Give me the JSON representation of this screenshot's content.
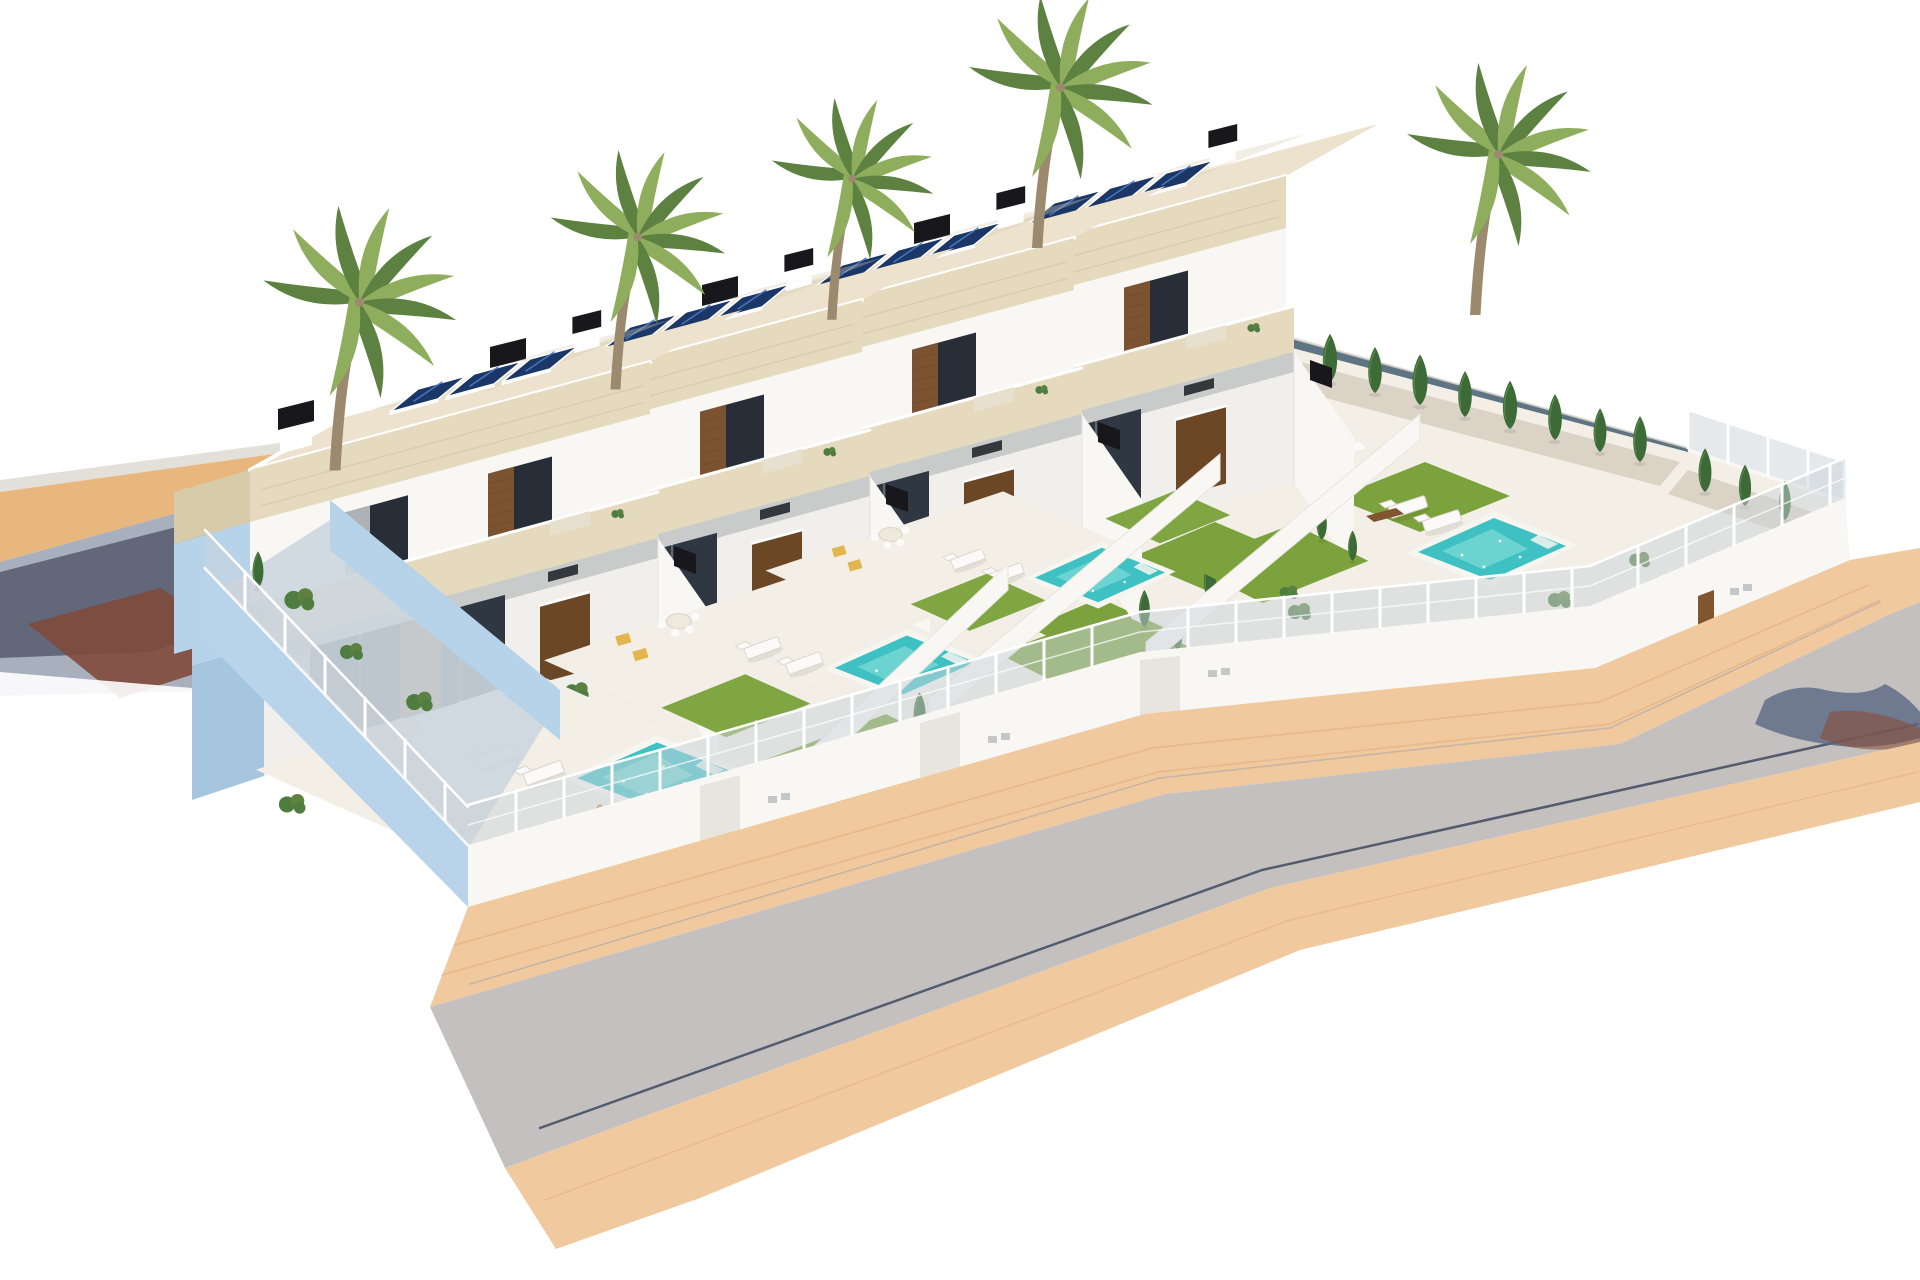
{
  "meta": {
    "title": "Aerial 3D architectural render",
    "description": "Computer-generated aerial rendering of a residential development with four modern two-storey white villas in a stepped row, each with flat cream roofs, rooftop solar panel arrays, black chimneys, balconies, covered terraces with outdoor kitchens, private turquoise pools, lawns, palm and cypress trees, all enclosed by a white perimeter wall with fencing; a grey asphalt street with peach brick sidewalks wraps around the plot on a white background."
  },
  "scene": {
    "villa_count": 4,
    "objects": [
      {
        "name": "villa",
        "count": 4
      },
      {
        "name": "solar-panel-array",
        "count": 4,
        "panels_per_array": 3
      },
      {
        "name": "chimney",
        "count": 8
      },
      {
        "name": "swimming-pool",
        "count": 4
      },
      {
        "name": "palm-tree",
        "count": 6
      },
      {
        "name": "cypress-tree",
        "count": 22
      },
      {
        "name": "sun-lounger",
        "count": 8
      },
      {
        "name": "dining-set",
        "count": 3
      },
      {
        "name": "lawn-patch",
        "count": 9
      },
      {
        "name": "perimeter-wall-with-fence",
        "count": 1
      },
      {
        "name": "street",
        "count": 2
      },
      {
        "name": "brick-sidewalk",
        "count": 3
      },
      {
        "name": "person-by-pool",
        "count": 1
      }
    ]
  },
  "palette": {
    "bg": "#ffffff",
    "back_sidewalk": "#e8b77d",
    "curb": "#dcd7cf",
    "sidewalk": "#f0c99e",
    "sidewalk_line": "#dca878",
    "road": "#c4c0bf",
    "road_left": "#a8b0bd",
    "road_navy": "#565a6e",
    "road_brown": "#7f4a3b",
    "gutter": "#3f4a5e",
    "gutter_soft": "#9aa0aa",
    "tree_shadow": "#5a6783",
    "tree_shadow_warm": "#8a4f3a",
    "platform": "#f2eee6",
    "terrace": "#f3efe7",
    "wall_white": "#f8f7f4",
    "wall_white2": "#f1efeb",
    "wall_shade": "#e8e5de",
    "blue_wall": "#b7d3e9",
    "blue_wall_dark": "#a6c6df",
    "blue_wall_big": "#b9d4ea",
    "fascia": "#e5dabe",
    "fascia_side": "#d8cba9",
    "fascia_line": "#cfc19d",
    "roof_top": "#ece2cd",
    "roof_mottle": "#dbcfb4",
    "window_dark": "#272e38",
    "curtain": "#c6c9cd",
    "glass": "#2e3742",
    "wood": "#80552f",
    "wood_dark": "#6b4726",
    "hood_dark": "#33383d",
    "solar": "#1b3768",
    "solar_light": "#4f7cc2",
    "chimney": "#17171c",
    "white": "#ffffff",
    "fence_panel": "#ccd3d9",
    "slate": "#5e7482",
    "slate_light": "#8fa5b0",
    "lawn": "#7ba23c",
    "lawn_dark": "#669030",
    "pool_rim": "#f7f5f0",
    "pool_water": "#3fc0c3",
    "pool_light": "#8fe2da",
    "cypress": "#3d6b38",
    "cypress_light": "#6f9a55",
    "shrub": "#4e7d3f",
    "palm_dark": "#5d8140",
    "palm_light": "#8fae5d",
    "trunk": "#9c8a6e",
    "gravel": "#d7cfc2",
    "cushion": "#e2b54e",
    "furniture": "#fbfaf8",
    "furniture_line": "#d9d5cd",
    "sofa_beige": "#e8e0ce",
    "table_top": "#efe9dd",
    "skin": "#c08a62",
    "shadow": "#9aa0a4",
    "courtyard_floor": "#ccd6de"
  }
}
